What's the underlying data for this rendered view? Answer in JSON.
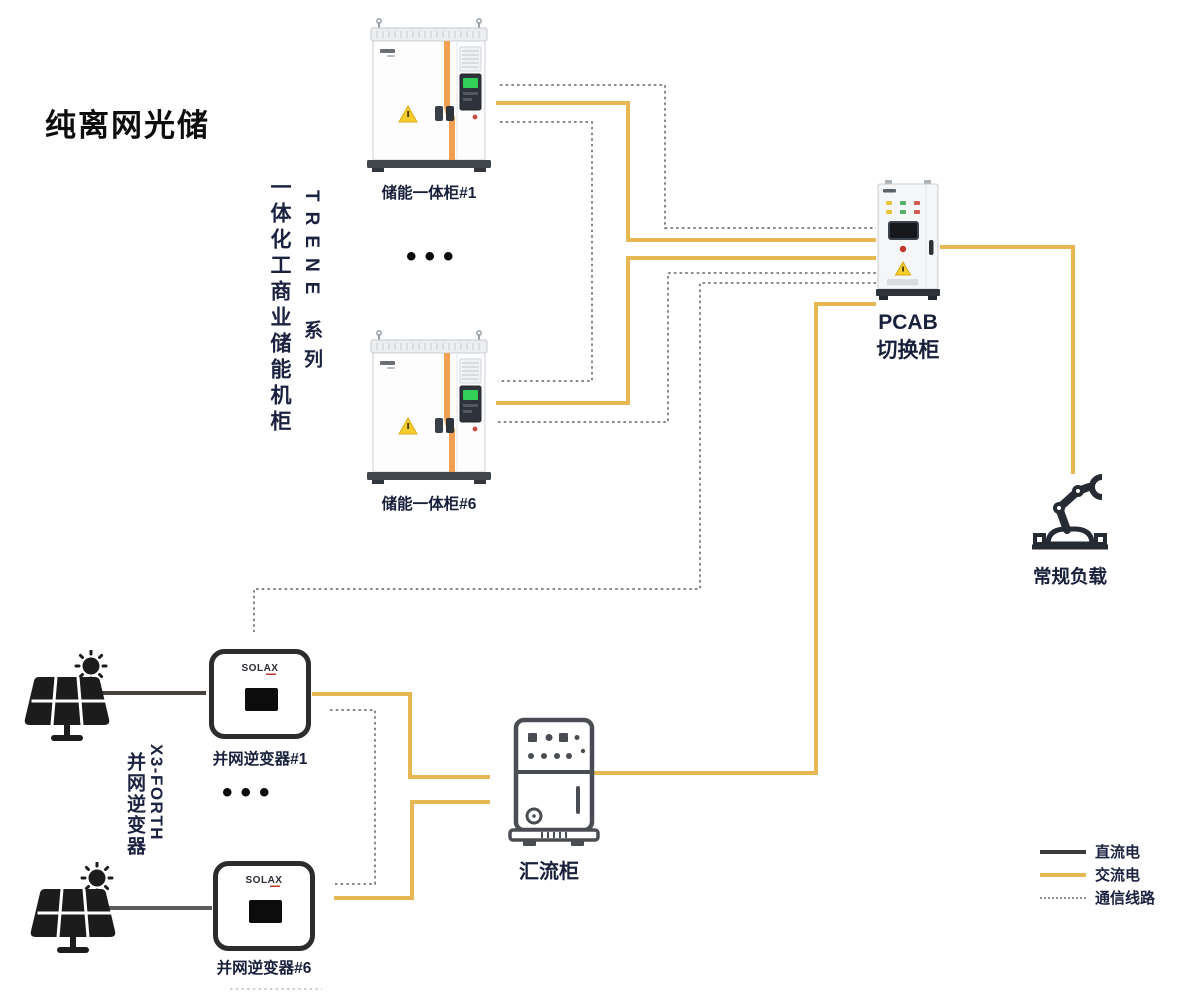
{
  "title": "纯离网光储",
  "storage": {
    "product_label": "一体化工商业储能机柜",
    "series_label": "TRENE 系列",
    "cabinet1_label": "储能一体柜#1",
    "cabinet6_label": "储能一体柜#6",
    "ellipsis": "•••"
  },
  "pv": {
    "series_label": "X3-FORTH",
    "product_label": "并网逆变器",
    "inverter1_label": "并网逆变器#1",
    "inverter6_label": "并网逆变器#6",
    "inverter_logo": "SOLAX",
    "ellipsis": "•••"
  },
  "pcab": {
    "name": "PCAB",
    "type": "切换柜"
  },
  "combiner_label": "汇流柜",
  "load_label": "常规负载",
  "legend": {
    "dc": {
      "label": "直流电",
      "style": "solid",
      "color": "#3a3a3a"
    },
    "ac": {
      "label": "交流电",
      "style": "solid",
      "color": "#e7b754"
    },
    "comm": {
      "label": "通信线路",
      "style": "dotted",
      "color": "#8f8f8f"
    }
  },
  "colors": {
    "ac_wire": "#e7b754",
    "dc_wire": "#46413a",
    "comm_wire": "#878787",
    "label_navy": "#1b2240",
    "cabinet_stripe_orange": "#f0a050",
    "warning_yellow": "#f6cf2f"
  },
  "connections": [
    {
      "from": "储能一体柜#1",
      "to": "PCAB切换柜",
      "type": "交流电"
    },
    {
      "from": "储能一体柜#6",
      "to": "PCAB切换柜",
      "type": "交流电"
    },
    {
      "from": "储能一体柜#1",
      "to": "PCAB切换柜",
      "type": "通信线路"
    },
    {
      "from": "储能一体柜#1",
      "to": "储能一体柜#6",
      "type": "通信线路"
    },
    {
      "from": "储能一体柜#6",
      "to": "PCAB切换柜",
      "type": "通信线路"
    },
    {
      "from": "solar-panel",
      "to": "并网逆变器#1",
      "type": "直流电"
    },
    {
      "from": "solar-panel",
      "to": "并网逆变器#6",
      "type": "直流电"
    },
    {
      "from": "并网逆变器#1",
      "to": "汇流柜",
      "type": "交流电"
    },
    {
      "from": "并网逆变器#6",
      "to": "汇流柜",
      "type": "交流电"
    },
    {
      "from": "并网逆变器#1",
      "to": "并网逆变器#6",
      "type": "通信线路"
    },
    {
      "from": "PCAB切换柜",
      "to": "并网逆变器#1",
      "type": "通信线路"
    },
    {
      "from": "汇流柜",
      "to": "PCAB切换柜",
      "type": "交流电"
    },
    {
      "from": "PCAB切换柜",
      "to": "常规负载",
      "type": "交流电"
    }
  ]
}
